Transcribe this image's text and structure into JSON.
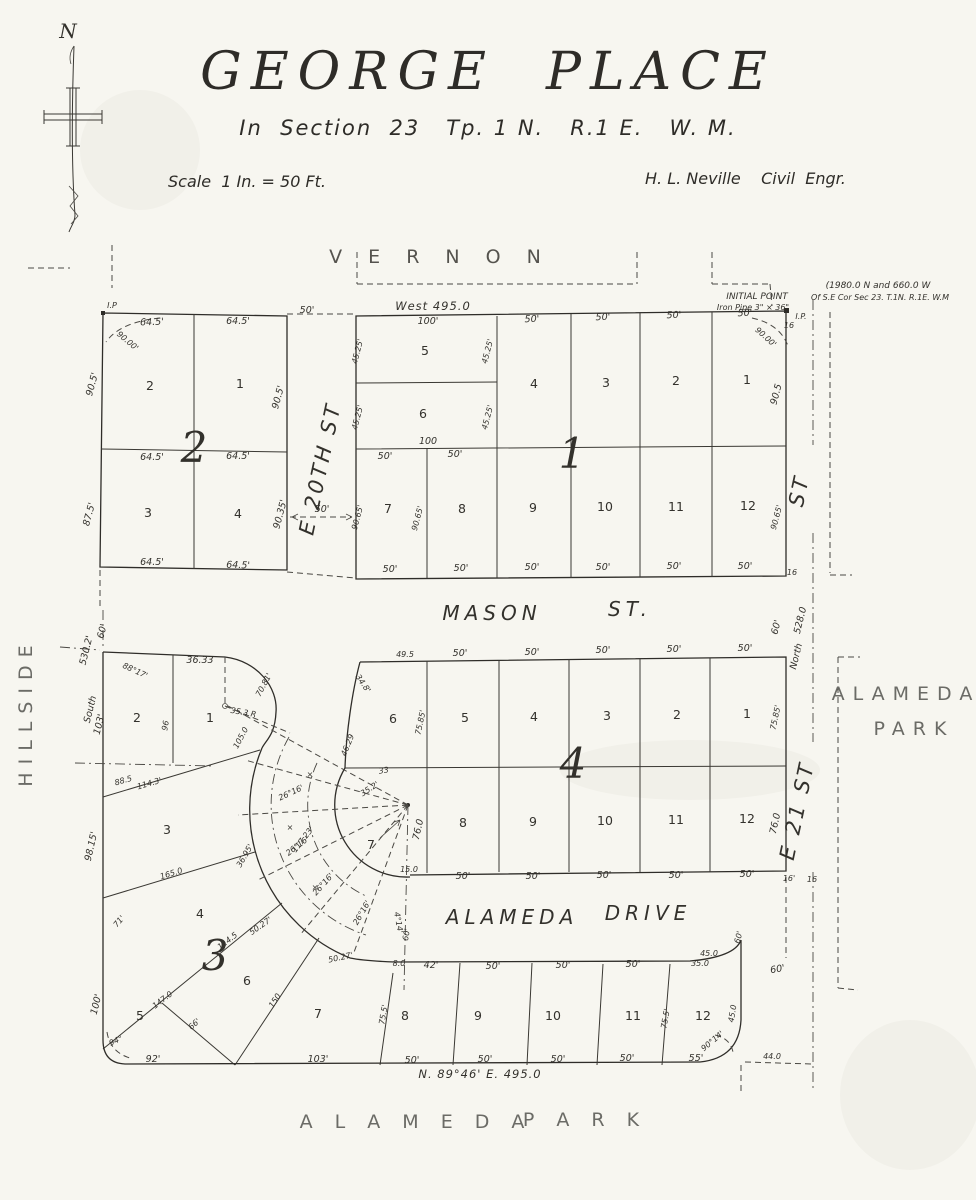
{
  "page": {
    "background": "#f7f6f0",
    "ink": "#2e2c28",
    "muted": "#6b6b66"
  },
  "header": {
    "title": "GEORGE  PLACE",
    "subtitle": "In  Section  23   Tp. 1 N.   R.1 E.   W. M.",
    "scale_note": "Scale  1 In. = 50 Ft.",
    "engineer": "H. L. Neville    Civil  Engr.",
    "compass_label": "N"
  },
  "label_format": "[text, x, y, rotation_deg, class]",
  "map_labels": [
    [
      "V E R N O N",
      440,
      263,
      0,
      "vern"
    ],
    [
      "West  495.0",
      433,
      310,
      0,
      "bearing"
    ],
    [
      "INITIAL POINT",
      757,
      299,
      0,
      "note"
    ],
    [
      "Iron Pipe  3\" × 36\"",
      753,
      310,
      0,
      "dim8"
    ],
    [
      "(1980.0 N and 660.0 W",
      878,
      288,
      0,
      "note"
    ],
    [
      "Of S.E Cor Sec 23. T.1N. R.1E. W.M",
      880,
      300,
      0,
      "dim8"
    ],
    [
      "I.P.",
      801,
      319,
      0,
      "dim8"
    ],
    [
      "16",
      789,
      328,
      0,
      "dim8"
    ],
    [
      "I.P",
      112,
      308,
      0,
      "dim8"
    ],
    [
      "E  20TH  ST",
      327,
      470,
      -78,
      "stv"
    ],
    [
      "MASON",
      492,
      620,
      0,
      "st"
    ],
    [
      "ST.",
      630,
      616,
      0,
      "st"
    ],
    [
      "ALAMEDA",
      512,
      924,
      0,
      "st"
    ],
    [
      "DRIVE",
      648,
      920,
      0,
      "st"
    ],
    [
      "A L A M E D A",
      416,
      1128,
      0,
      "park"
    ],
    [
      "P A R K",
      585,
      1126,
      0,
      "park"
    ],
    [
      "ALAMEDA",
      906,
      700,
      0,
      "park"
    ],
    [
      "PARK",
      914,
      735,
      0,
      "park"
    ],
    [
      "HILLSIDE",
      32,
      712,
      -90,
      "park"
    ],
    [
      "ST",
      806,
      492,
      -78,
      "stv"
    ],
    [
      "E  21  ST",
      804,
      812,
      -78,
      "stv"
    ],
    [
      "528.0",
      803,
      621,
      -76,
      "dim"
    ],
    [
      "North",
      799,
      657,
      -76,
      "dim"
    ],
    [
      "16",
      792,
      575,
      0,
      "dim8"
    ],
    [
      "60'",
      779,
      628,
      -75,
      "dim"
    ],
    [
      "64.5'",
      152,
      325,
      -2,
      "dim"
    ],
    [
      "64.5'",
      238,
      324,
      0,
      "dim"
    ],
    [
      "50'",
      307,
      313,
      0,
      "dim"
    ],
    [
      "90.00'",
      126,
      343,
      40,
      "dim8"
    ],
    [
      "90.5'",
      95,
      385,
      -75,
      "dim"
    ],
    [
      "90.5'",
      281,
      398,
      -75,
      "dim"
    ],
    [
      "2",
      150,
      390,
      0,
      "lot"
    ],
    [
      "1",
      240,
      388,
      0,
      "lot"
    ],
    [
      "2",
      194,
      462,
      0,
      "blk"
    ],
    [
      "64.5'",
      152,
      460,
      0,
      "dim"
    ],
    [
      "64.5'",
      238,
      459,
      0,
      "dim"
    ],
    [
      "87.5'",
      92,
      515,
      -75,
      "dim"
    ],
    [
      "90.35'",
      283,
      515,
      -75,
      "dim"
    ],
    [
      "3",
      148,
      517,
      0,
      "lot"
    ],
    [
      "4",
      238,
      518,
      0,
      "lot"
    ],
    [
      "64.5'",
      152,
      565,
      0,
      "dim"
    ],
    [
      "64.5'",
      238,
      568,
      2,
      "dim"
    ],
    [
      "50'",
      322,
      512,
      0,
      "dim"
    ],
    [
      "100'",
      428,
      324,
      0,
      "dim"
    ],
    [
      "50'",
      532,
      322,
      -2,
      "dim"
    ],
    [
      "50'",
      603,
      320,
      -2,
      "dim"
    ],
    [
      "50'",
      674,
      318,
      -2,
      "dim"
    ],
    [
      "50'",
      745,
      316,
      -2,
      "dim"
    ],
    [
      "90.00'",
      764,
      339,
      42,
      "dim8"
    ],
    [
      "45.25'",
      360,
      352,
      -75,
      "dim8"
    ],
    [
      "45.25'",
      490,
      352,
      -75,
      "dim8"
    ],
    [
      "45.25'",
      360,
      418,
      -75,
      "dim8"
    ],
    [
      "45.25'",
      490,
      418,
      -75,
      "dim8"
    ],
    [
      "90.5",
      779,
      395,
      -75,
      "dim"
    ],
    [
      "5",
      425,
      355,
      0,
      "lot"
    ],
    [
      "6",
      423,
      418,
      0,
      "lot"
    ],
    [
      "4",
      534,
      388,
      0,
      "lot"
    ],
    [
      "3",
      606,
      387,
      0,
      "lot"
    ],
    [
      "2",
      676,
      385,
      0,
      "lot"
    ],
    [
      "1",
      747,
      384,
      0,
      "lot"
    ],
    [
      "100",
      428,
      444,
      0,
      "dim"
    ],
    [
      "50'",
      385,
      459,
      0,
      "dim"
    ],
    [
      "50'",
      455,
      457,
      0,
      "dim"
    ],
    [
      "1",
      572,
      468,
      0,
      "blk"
    ],
    [
      "90.65'",
      360,
      518,
      -75,
      "dim8"
    ],
    [
      "90.65'",
      420,
      519,
      -75,
      "dim8"
    ],
    [
      "90.65'",
      779,
      518,
      -75,
      "dim8"
    ],
    [
      "7",
      388,
      513,
      0,
      "lot"
    ],
    [
      "8",
      462,
      513,
      0,
      "lot"
    ],
    [
      "9",
      533,
      512,
      0,
      "lot"
    ],
    [
      "10",
      605,
      511,
      0,
      "lot"
    ],
    [
      "11",
      676,
      511,
      0,
      "lot"
    ],
    [
      "12",
      748,
      510,
      0,
      "lot"
    ],
    [
      "50'",
      390,
      572,
      0,
      "dim"
    ],
    [
      "50'",
      461,
      571,
      0,
      "dim"
    ],
    [
      "50'",
      532,
      570,
      0,
      "dim"
    ],
    [
      "50'",
      603,
      570,
      0,
      "dim"
    ],
    [
      "50'",
      674,
      569,
      0,
      "dim"
    ],
    [
      "50'",
      745,
      569,
      0,
      "dim"
    ],
    [
      "60'",
      105,
      632,
      -75,
      "dim"
    ],
    [
      "530.2'",
      89,
      651,
      -76,
      "dim"
    ],
    [
      "South",
      93,
      710,
      -76,
      "dim"
    ],
    [
      "103'",
      102,
      725,
      -76,
      "dim"
    ],
    [
      "88°17'",
      134,
      673,
      25,
      "dim8"
    ],
    [
      "36.33",
      200,
      663,
      0,
      "dim"
    ],
    [
      "96",
      168,
      726,
      -80,
      "dim8"
    ],
    [
      "2",
      137,
      722,
      0,
      "lot"
    ],
    [
      "1",
      210,
      722,
      0,
      "lot"
    ],
    [
      "70.81'",
      266,
      686,
      -62,
      "dim8"
    ],
    [
      "35.3 R",
      243,
      715,
      10,
      "dim8"
    ],
    [
      "105.0",
      243,
      739,
      -62,
      "dim8"
    ],
    [
      "46.29",
      350,
      746,
      -68,
      "dim8"
    ],
    [
      "88.5",
      124,
      783,
      -16,
      "dim8"
    ],
    [
      "114.3'",
      150,
      786,
      -16,
      "dim8"
    ],
    [
      "98.15'",
      94,
      847,
      -77,
      "dim"
    ],
    [
      "3",
      167,
      834,
      0,
      "lot"
    ],
    [
      "165.0",
      172,
      876,
      -17,
      "dim8"
    ],
    [
      "71'",
      121,
      923,
      -50,
      "dim8"
    ],
    [
      "114.5",
      229,
      943,
      -38,
      "dim8"
    ],
    [
      "3",
      215,
      970,
      0,
      "blk"
    ],
    [
      "147.0",
      164,
      1002,
      -38,
      "dim8"
    ],
    [
      "4",
      200,
      918,
      0,
      "lot"
    ],
    [
      "5",
      140,
      1020,
      0,
      "lot"
    ],
    [
      "6",
      247,
      985,
      0,
      "lot"
    ],
    [
      "7",
      318,
      1018,
      0,
      "lot"
    ],
    [
      "100'",
      99,
      1005,
      -76,
      "dim"
    ],
    [
      "94°",
      117,
      1043,
      -25,
      "dim8"
    ],
    [
      "92'",
      153,
      1062,
      0,
      "dim"
    ],
    [
      "66'",
      196,
      1026,
      -42,
      "dim8"
    ],
    [
      "150",
      277,
      1002,
      -57,
      "dim8"
    ],
    [
      "103'",
      318,
      1062,
      0,
      "dim"
    ],
    [
      "49.5",
      405,
      657,
      0,
      "dim8"
    ],
    [
      "50'",
      460,
      656,
      0,
      "dim"
    ],
    [
      "50'",
      532,
      655,
      0,
      "dim"
    ],
    [
      "50'",
      603,
      653,
      0,
      "dim"
    ],
    [
      "50'",
      674,
      652,
      0,
      "dim"
    ],
    [
      "50'",
      745,
      651,
      0,
      "dim"
    ],
    [
      "34.8'",
      361,
      685,
      55,
      "dim8"
    ],
    [
      "75.85'",
      423,
      723,
      -78,
      "dim8"
    ],
    [
      "75.85'",
      778,
      718,
      -78,
      "dim8"
    ],
    [
      "6",
      393,
      723,
      0,
      "lot"
    ],
    [
      "5",
      465,
      722,
      0,
      "lot"
    ],
    [
      "4",
      534,
      721,
      0,
      "lot"
    ],
    [
      "3",
      607,
      720,
      0,
      "lot"
    ],
    [
      "2",
      677,
      719,
      0,
      "lot"
    ],
    [
      "1",
      747,
      718,
      0,
      "lot"
    ],
    [
      "4",
      573,
      778,
      0,
      "blk"
    ],
    [
      "33",
      384,
      773,
      -8,
      "dim8"
    ],
    [
      "35.2'",
      371,
      791,
      -33,
      "dim8"
    ],
    [
      "76.0",
      421,
      830,
      -78,
      "dim"
    ],
    [
      "76.0",
      778,
      824,
      -78,
      "dim"
    ],
    [
      "8",
      463,
      827,
      0,
      "lot"
    ],
    [
      "9",
      533,
      826,
      0,
      "lot"
    ],
    [
      "10",
      605,
      825,
      0,
      "lot"
    ],
    [
      "11",
      676,
      824,
      0,
      "lot"
    ],
    [
      "12",
      747,
      823,
      0,
      "lot"
    ],
    [
      "7",
      371,
      849,
      0,
      "lot"
    ],
    [
      "15.0",
      409,
      872,
      0,
      "dim8"
    ],
    [
      "50'",
      463,
      879,
      0,
      "dim"
    ],
    [
      "50'",
      533,
      879,
      0,
      "dim"
    ],
    [
      "50'",
      604,
      878,
      0,
      "dim"
    ],
    [
      "50'",
      676,
      878,
      0,
      "dim"
    ],
    [
      "50'",
      747,
      877,
      0,
      "dim"
    ],
    [
      "16'",
      789,
      881,
      0,
      "dim8"
    ],
    [
      "16",
      812,
      882,
      0,
      "dim8"
    ],
    [
      "26°16'",
      292,
      795,
      -25,
      "dim8"
    ],
    [
      "26°16'",
      299,
      848,
      -38,
      "dim8"
    ],
    [
      "26°16'",
      325,
      886,
      -48,
      "dim8"
    ],
    [
      "26°16'",
      364,
      914,
      -60,
      "dim8"
    ],
    [
      "117.23'",
      305,
      841,
      -52,
      "dim8"
    ],
    [
      "36.95'",
      247,
      857,
      -60,
      "dim8"
    ],
    [
      "50.27'",
      262,
      928,
      -35,
      "dim8"
    ],
    [
      "50.27'",
      341,
      960,
      -12,
      "dim8"
    ],
    [
      "×",
      310,
      777,
      0,
      "dim8"
    ],
    [
      "×",
      290,
      830,
      0,
      "dim8"
    ],
    [
      "×",
      315,
      890,
      0,
      "dim8"
    ],
    [
      "4°14'",
      396,
      923,
      80,
      "dim8"
    ],
    [
      "60'",
      409,
      935,
      -80,
      "dim8"
    ],
    [
      "8.0",
      399,
      966,
      0,
      "dim8"
    ],
    [
      "42'",
      431,
      968,
      0,
      "dim"
    ],
    [
      "50'",
      493,
      969,
      0,
      "dim"
    ],
    [
      "50'",
      563,
      968,
      0,
      "dim"
    ],
    [
      "50'",
      633,
      967,
      0,
      "dim"
    ],
    [
      "35.0",
      700,
      966,
      0,
      "dim8"
    ],
    [
      "45.0",
      709,
      956,
      0,
      "dim8"
    ],
    [
      "60'",
      741,
      938,
      -75,
      "dim8"
    ],
    [
      "60'",
      778,
      972,
      -10,
      "dim"
    ],
    [
      "75.5'",
      386,
      1015,
      -80,
      "dim8"
    ],
    [
      "75.5'",
      668,
      1019,
      -80,
      "dim8"
    ],
    [
      "8",
      405,
      1020,
      0,
      "lot"
    ],
    [
      "9",
      478,
      1020,
      0,
      "lot"
    ],
    [
      "10",
      553,
      1020,
      0,
      "lot"
    ],
    [
      "11",
      633,
      1020,
      0,
      "lot"
    ],
    [
      "12",
      703,
      1020,
      0,
      "lot"
    ],
    [
      "50'",
      412,
      1063,
      0,
      "dim"
    ],
    [
      "50'",
      485,
      1062,
      0,
      "dim"
    ],
    [
      "50'",
      558,
      1062,
      0,
      "dim"
    ],
    [
      "50'",
      627,
      1061,
      0,
      "dim"
    ],
    [
      "55'",
      696,
      1061,
      0,
      "dim"
    ],
    [
      "45.0",
      735,
      1014,
      -80,
      "dim8"
    ],
    [
      "90°14'",
      714,
      1043,
      -40,
      "dim8"
    ],
    [
      "44.0",
      772,
      1059,
      0,
      "dim8"
    ],
    [
      "N. 89°46' E.   495.0",
      480,
      1078,
      0,
      "bearing"
    ]
  ]
}
